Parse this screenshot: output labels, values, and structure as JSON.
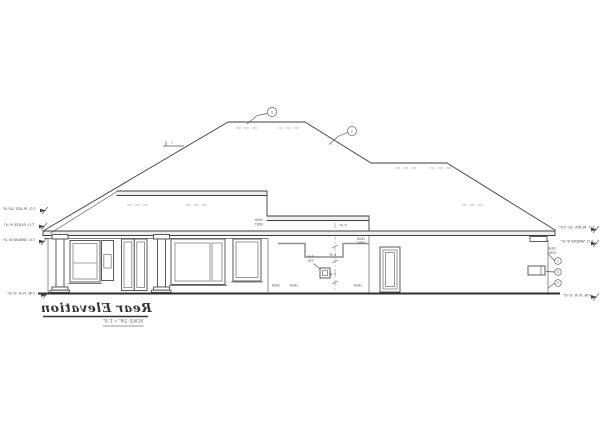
{
  "title_block": {
    "title": "Rear Elevation",
    "scale": "SCALE: 1/4\" = 1'-0\""
  },
  "elevation_labels": {
    "left": [
      "T.O. PLATE 10'-8\"",
      "T.O. PLATE 9'-4\"",
      "T.O. WNDW 8'-0\"",
      "FIN. FLR. 0'-0\""
    ],
    "right": [
      "T.O. PLATE 10'-10\"",
      "T.O. WNDW 8'-0\"",
      "FIN. FLR. 0'-0\""
    ]
  },
  "keynotes": {
    "roof": [
      "2",
      "1"
    ],
    "wall": [
      "1",
      "2",
      "3"
    ]
  },
  "pitch_label": "7",
  "notes": {
    "vent_line1": "16x8",
    "vent_line2": "VENT",
    "box_line1": "4x4",
    "box_line2": "TYP.",
    "dims": [
      "9'-4\"",
      "6'-8\"",
      "2'-8\""
    ],
    "base_marks": [
      "16x8",
      "16x8",
      "16x8"
    ]
  }
}
